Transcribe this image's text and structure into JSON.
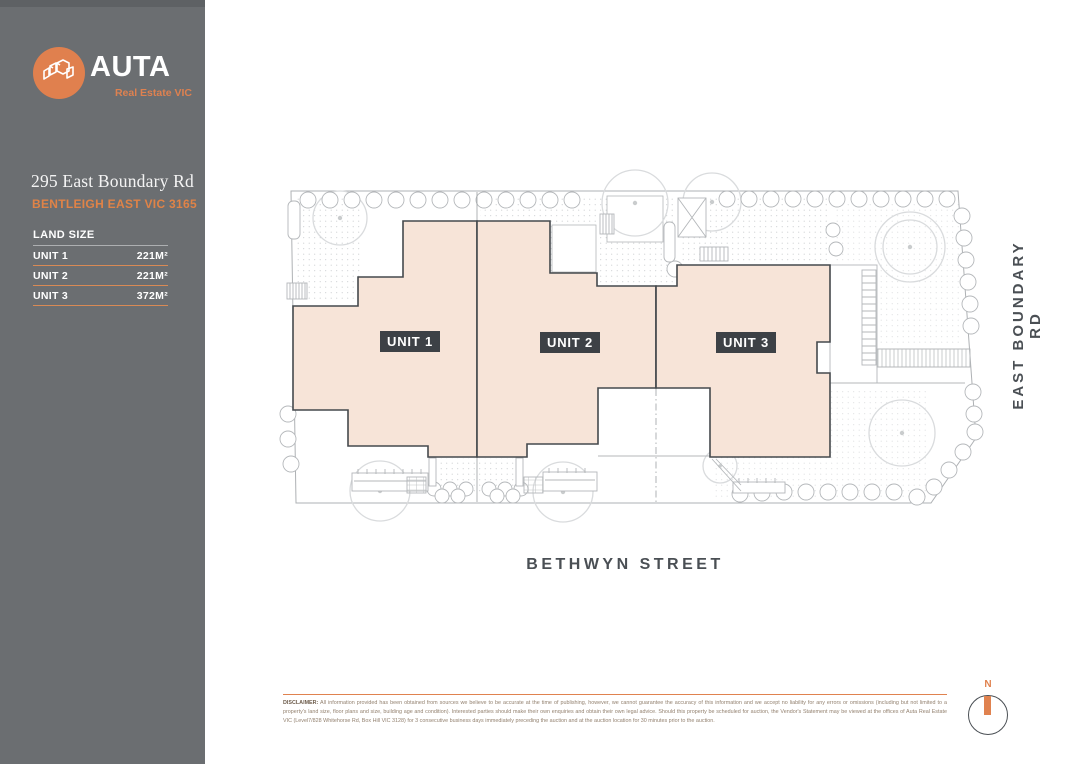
{
  "sidebar": {
    "logo": {
      "brand": "AUTA",
      "tagline": "Real Estate VIC",
      "icon": "buildings-isometric"
    },
    "address_line1": "295 East Boundary Rd",
    "address_line2": "BENTLEIGH EAST VIC 3165",
    "land_size": {
      "header": "LAND SIZE",
      "rows": [
        {
          "label": "UNIT 1",
          "value": "221M²"
        },
        {
          "label": "UNIT 2",
          "value": "221M²"
        },
        {
          "label": "UNIT 3",
          "value": "372M²"
        }
      ]
    }
  },
  "plan": {
    "unit_labels": [
      "UNIT 1",
      "UNIT 2",
      "UNIT 3"
    ],
    "street_label": "BETHWYN STREET",
    "road_label": "EAST BOUNDARY RD",
    "compass": {
      "north_label": "N"
    }
  },
  "footer": {
    "disclaimer_label": "DISCLAIMER:",
    "disclaimer_text": " All information provided has been obtained from sources we believe to be accurate at the time of publishing, however, we cannot guarantee the accuracy of this information and we accept no liability for any errors or omissions (including but not limited to a property's land size, floor plans and size, building age and condition). Interested parties should make their own enquiries and obtain their own legal advice. Should this property be scheduled for auction, the Vendor's Statement may be viewed at the offices of Auta Real Estate VIC (Level7/828 Whitehorse Rd, Box Hill VIC 3128) for 3 consecutive business days immediately preceding the auction and at the auction location for 30 minutes prior to the auction."
  },
  "colors": {
    "accent_orange": "#e0824f",
    "sidebar_gray": "#6b6e71",
    "unit_fill": "#f7e4d8",
    "outline_ink": "#45494d",
    "plan_line": "#b4b7ba"
  }
}
